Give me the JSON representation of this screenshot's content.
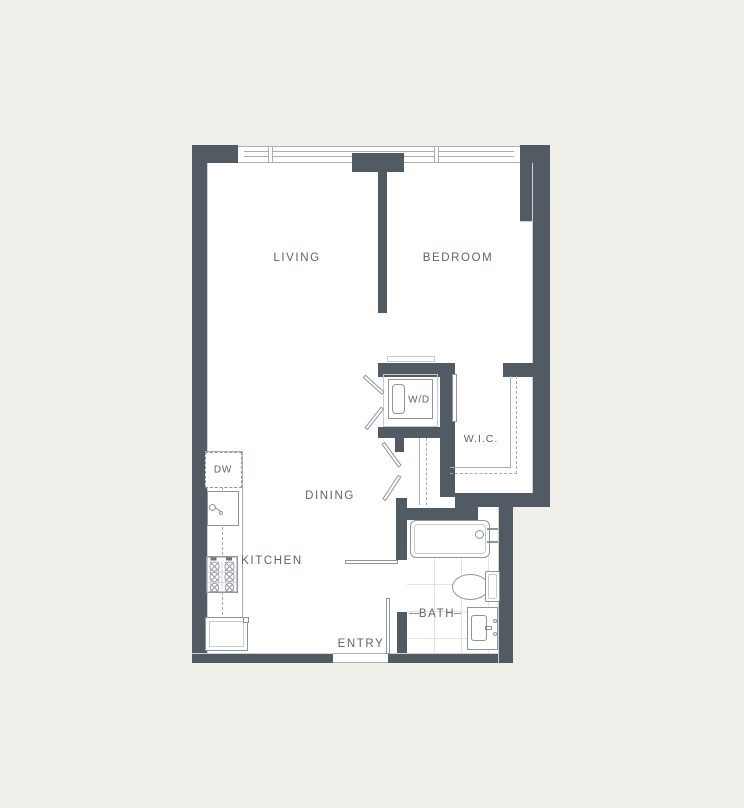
{
  "labels": {
    "living": "LIVING",
    "bedroom": "BEDROOM",
    "dining": "DINING",
    "kitchen": "KITCHEN",
    "wd": "W/D",
    "wic": "W.I.C.",
    "bath": "BATH",
    "entry": "ENTRY",
    "dw": "DW"
  },
  "colors": {
    "wall": "#525a64",
    "background": "#f0efe9",
    "floor": "#ffffff",
    "line": "#8e959c",
    "lightline": "#c6cbce",
    "dashed": "#a5abb1",
    "tile": "#e0e3e4",
    "label": "#5d6571",
    "thin": "#a9afb5"
  }
}
